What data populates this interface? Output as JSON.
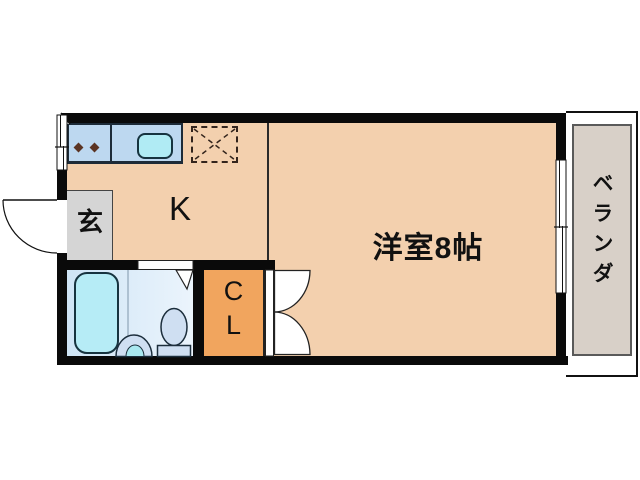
{
  "title": "apartment-floor-plan",
  "rooms": {
    "kitchen": {
      "label": "K"
    },
    "main_room": {
      "label": "洋室8帖"
    },
    "entrance": {
      "label": "玄"
    },
    "closet": {
      "lines": [
        "C",
        "L"
      ]
    },
    "veranda": {
      "label": "ベランダ"
    }
  },
  "colors": {
    "wall": "#0a0a0a",
    "floor": "#f3d0ae",
    "closet": "#f1a55e",
    "entrance": "#d5d5d5",
    "veranda": "#d8d0c8",
    "counter": "#bdd8f0",
    "sink": "#b0ebf4",
    "bathtub": "#b6ecf6",
    "bath_floor_l": "#cfe5f6",
    "bath_floor_r": "#ebf4fc",
    "fixture": "#cfdff2",
    "fixture_inner": "#a9e8f0",
    "burner": "#5b3423",
    "outline": "#16333f"
  }
}
